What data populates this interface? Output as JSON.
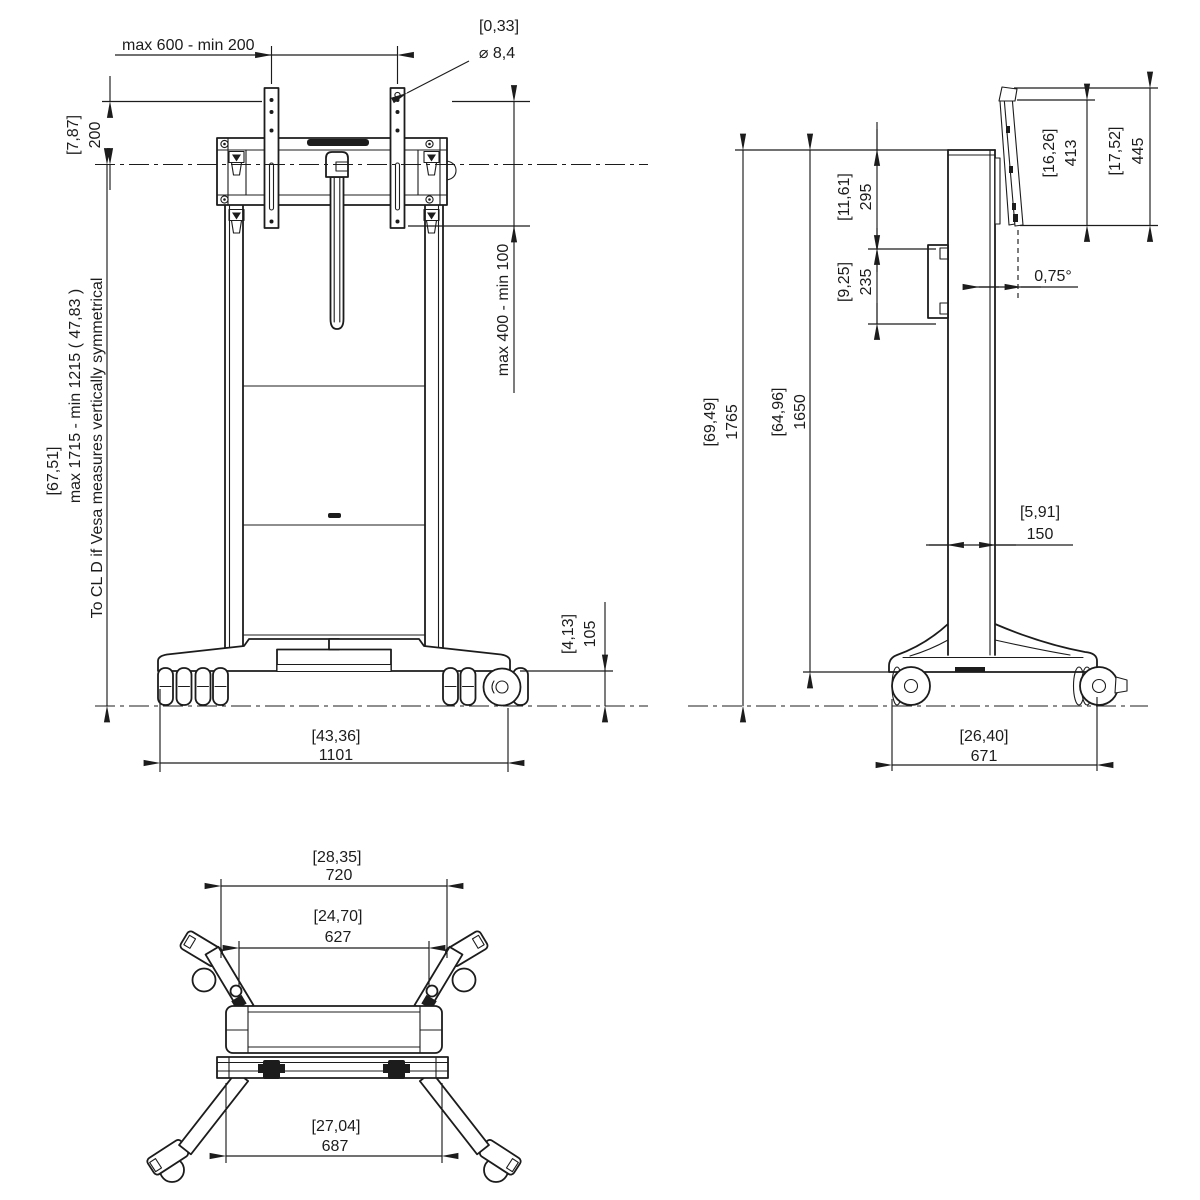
{
  "colors": {
    "ink": "#1c1c1c",
    "background": "#ffffff"
  },
  "fv": {
    "vesa_width": "max 600 - min 200",
    "hole_in": "[0,33]",
    "hole_dia": "⌀ 8,4",
    "off200_in": "[7,87]",
    "off200_mm": "200",
    "height_in": "[67,51]",
    "height_mm": "max  1715  - min 1215 ( 47,83 )",
    "height_note": "To CL D if Vesa measures vertically symmetrical",
    "vesa_height": "max 400 - min 100",
    "base_h_in": "[4,13]",
    "base_h_mm": "105",
    "width_in": "[43,36]",
    "width_mm": "1101"
  },
  "sv": {
    "d295_in": "[11,61]",
    "d295_mm": "295",
    "d235_in": "[9,25]",
    "d235_mm": "235",
    "d413_in": "[16,26]",
    "d413_mm": "413",
    "d445_in": "[17,52]",
    "d445_mm": "445",
    "tilt": "0,75°",
    "d1765_in": "[69,49]",
    "d1765_mm": "1765",
    "d1650_in": "[64,96]",
    "d1650_mm": "1650",
    "d150_in": "[5,91]",
    "d150_mm": "150",
    "d671_in": "[26,40]",
    "d671_mm": "671"
  },
  "pv": {
    "d720_in": "[28,35]",
    "d720_mm": "720",
    "d627_in": "[24,70]",
    "d627_mm": "627",
    "d687_in": "[27,04]",
    "d687_mm": "687"
  }
}
